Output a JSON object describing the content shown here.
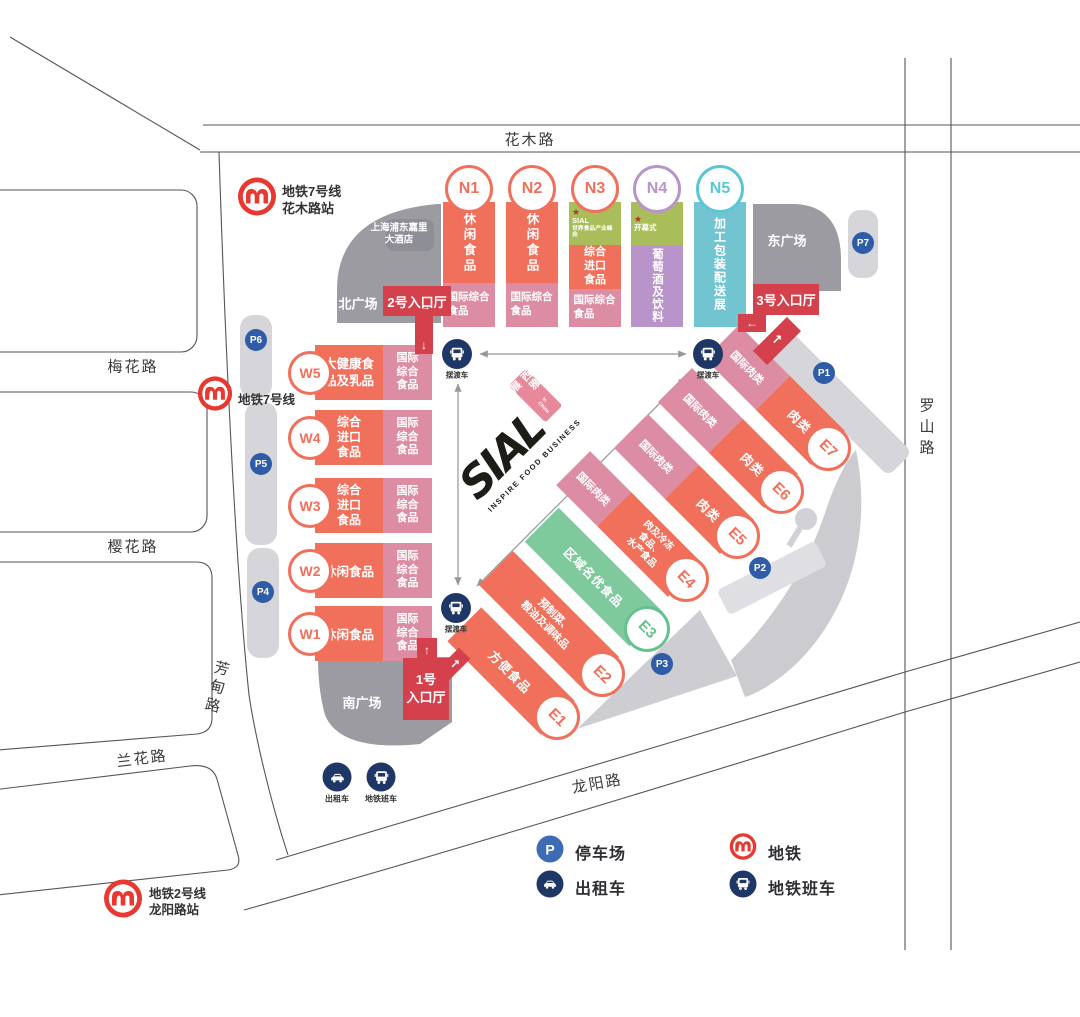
{
  "roads": {
    "top": "花木路",
    "left1": "梅花路",
    "left2": "樱花路",
    "left3": "兰花路",
    "left_vertical": "芳甸路",
    "right": "罗山路",
    "bottom": "龙阳路"
  },
  "stations": {
    "line7_huamu": "地铁7号线\n花木路站",
    "line7": "地铁7号线",
    "line2_longyang": "地铁2号线\n龙阳路站"
  },
  "plazas": {
    "north": "北广场",
    "south": "南广场",
    "east": "东广场"
  },
  "hotel": "上海浦东嘉里\n大酒店",
  "entrances": {
    "no1": "1号\n入口厅",
    "no2": "2号入口厅",
    "no3": "3号入口厅"
  },
  "shuttle": "摆渡车",
  "transport": {
    "taxi": "出租车",
    "metro_shuttle": "地铁班车"
  },
  "halls": {
    "n": [
      {
        "id": "N1",
        "main": "休闲食品",
        "sub": "国际综合食品"
      },
      {
        "id": "N2",
        "main": "休闲食品",
        "sub": "国际综合食品"
      },
      {
        "id": "N3",
        "tag_star": "★",
        "tag_line1": "SIAL",
        "tag_line2": "世界食品产业峰会",
        "main": "综合进口食品",
        "sub": "国际综合食品"
      },
      {
        "id": "N4",
        "tag_star": "★",
        "tag_line1": "开幕式",
        "main": "葡萄酒及饮料"
      },
      {
        "id": "N5",
        "main": "加工包装配送展"
      }
    ],
    "w": [
      {
        "id": "W5",
        "main": "大健康食品及乳品",
        "sub": "国际综合食品"
      },
      {
        "id": "W4",
        "main": "综合进口食品",
        "sub": "国际综合食品"
      },
      {
        "id": "W3",
        "main": "综合进口食品",
        "sub": "国际综合食品"
      },
      {
        "id": "W2",
        "main": "休闲食品",
        "sub": "国际综合食品"
      },
      {
        "id": "W1",
        "main": "休闲食品",
        "sub": "国际综合食品"
      }
    ],
    "e": [
      {
        "id": "E1",
        "main": "方便食品"
      },
      {
        "id": "E2",
        "main": "预制菜、\n粮油及调味品"
      },
      {
        "id": "E3",
        "main": "区域名优食品"
      },
      {
        "id": "E4",
        "intl": "国际肉类",
        "main": "肉及冷冻\n食品、\n水产食品"
      },
      {
        "id": "E5",
        "intl": "国际肉类",
        "main": "肉类"
      },
      {
        "id": "E6",
        "intl": "国际肉类",
        "main": "肉类"
      },
      {
        "id": "E7",
        "intl": "国际肉类",
        "main": "肉类"
      }
    ]
  },
  "parking": {
    "p1": "P1",
    "p2": "P2",
    "p3": "P3",
    "p4": "P4",
    "p5": "P5",
    "p6": "P6",
    "p7": "P7"
  },
  "legend": {
    "p_symbol": "P",
    "parking": "停车场",
    "taxi": "出租车",
    "metro": "地铁",
    "metro_shuttle": "地铁班车"
  },
  "logo": {
    "name": "SIAL",
    "cn": "西雅展",
    "cn_sub": "in China",
    "tagline": "INSPIRE FOOD BUSINESS"
  },
  "icons": {
    "arrow_up": "↑",
    "arrow_down": "↓",
    "arrow_left": "←",
    "arrow_right": "→",
    "arrow_ne": "↗"
  },
  "colors": {
    "orange": "#F0705B",
    "pink": "#DC8DA3",
    "red": "#D4414D",
    "olive": "#A9BE5B",
    "purple": "#B994CB",
    "teal": "#72C4D0",
    "green": "#7FCA9D",
    "navy": "#1F3767",
    "badge": "#2E5CA6",
    "metrored": "#E8382F",
    "graydark": "#9B9BA1",
    "graylight": "#D6D6DA",
    "graymid": "#CBCBD0"
  }
}
